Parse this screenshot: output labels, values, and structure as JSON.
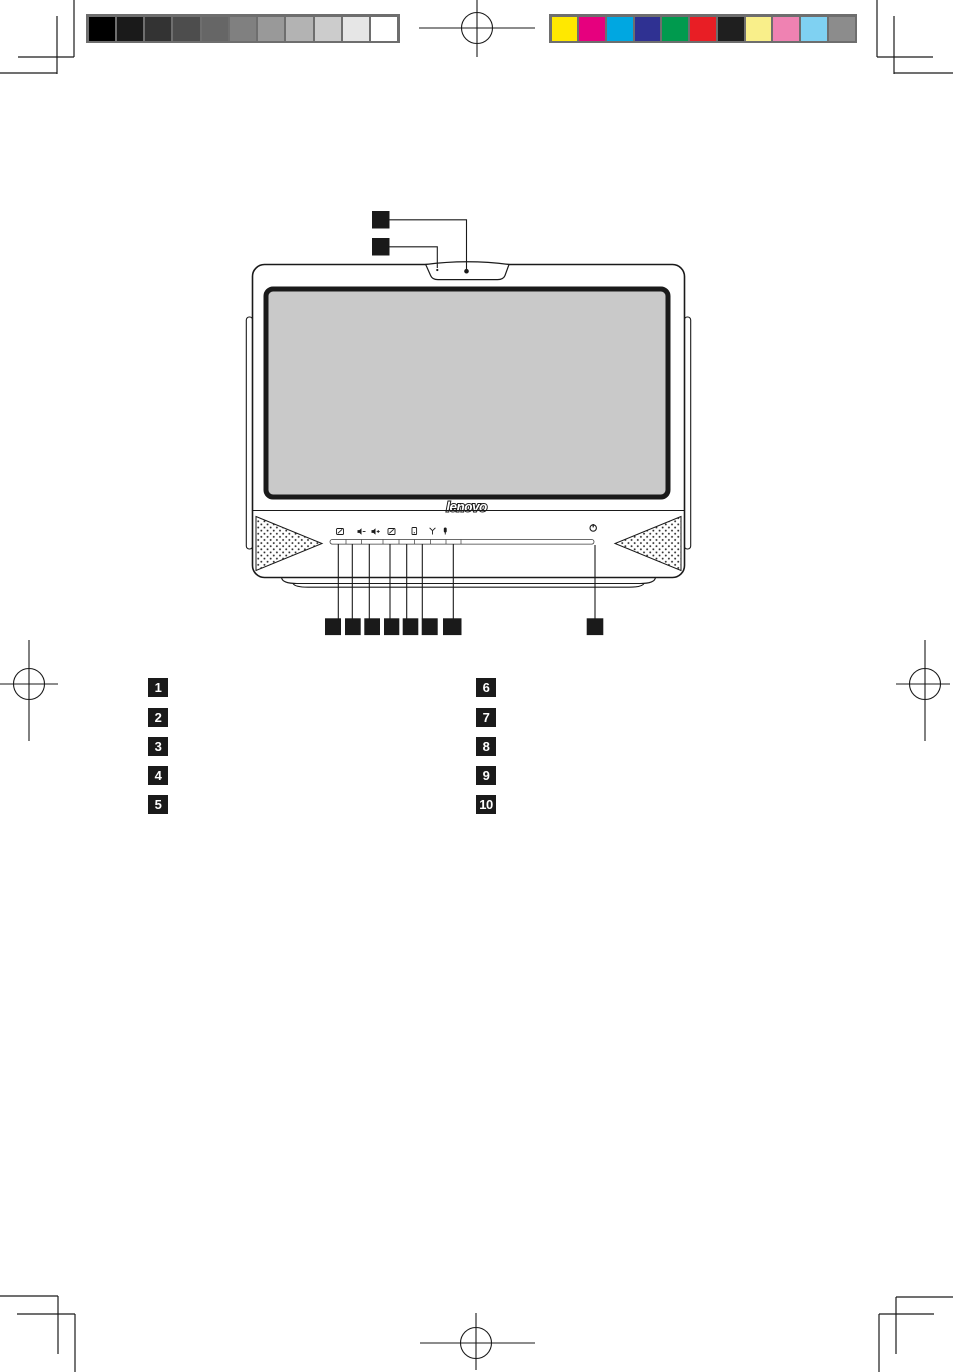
{
  "page": {
    "width": 953,
    "height": 1372,
    "background": "#ffffff"
  },
  "calibration": {
    "grayscale_bar": {
      "frame_color": "#6e6e6e",
      "swatches": [
        "#000000",
        "#1a1a1a",
        "#333333",
        "#4d4d4d",
        "#666666",
        "#808080",
        "#999999",
        "#b3b3b3",
        "#cccccc",
        "#e6e6e6",
        "#ffffff"
      ]
    },
    "color_bar": {
      "frame_color": "#6e6e6e",
      "swatches": [
        "#ffe800",
        "#e6007e",
        "#00a7e1",
        "#2f3192",
        "#009a4e",
        "#e81e25",
        "#1f1f1f",
        "#f9ef8a",
        "#ef82b2",
        "#7fd1f2",
        "#8c8c8c"
      ]
    }
  },
  "registration_marks": {
    "color": "#1a1a1a"
  },
  "illustration": {
    "brand_logo": "lenovo",
    "line_color": "#1a1a1a",
    "screen_fill": "#c9c9c9",
    "callout_marker_color": "#1a1a1a",
    "front_icons": [
      "display-toggle-icon",
      "volume-down-icon",
      "volume-up-icon",
      "lcd-off-icon",
      "hdd-indicator-icon",
      "wifi-indicator-icon",
      "microphone-indicator-icon",
      "power-icon"
    ]
  },
  "legend": {
    "left": [
      "1",
      "2",
      "3",
      "4",
      "5"
    ],
    "right": [
      "6",
      "7",
      "8",
      "9",
      "10"
    ]
  }
}
